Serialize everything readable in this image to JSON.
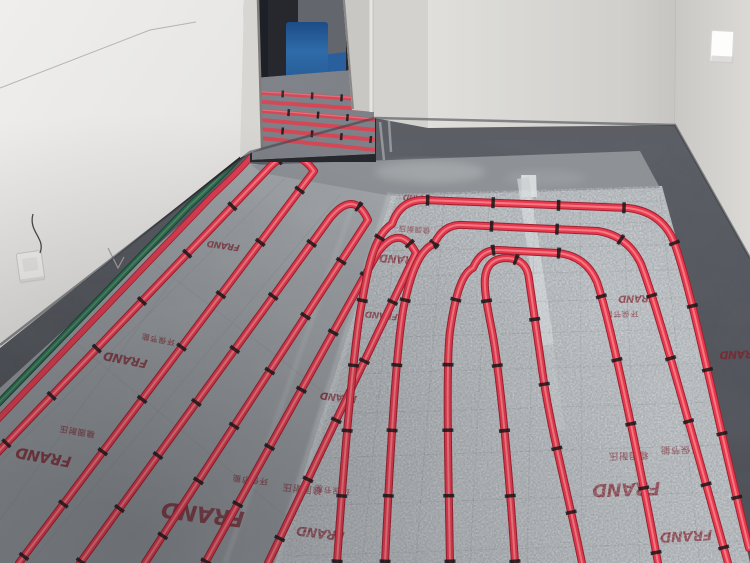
{
  "scene": {
    "type": "photograph",
    "subject": "Hydronic underfloor heating installation: red PEX pipe loops fixed with black clips onto silver foil insulation boards in an unfinished room with a doorway",
    "insulation": {
      "brand": "FRAND",
      "tagline_1": "稳固耐压",
      "tagline_2": "环保节能",
      "print_color": "#7c232f",
      "board_silver": "#a9aeb2",
      "board_matte": "#9c9fa2"
    },
    "pipes": {
      "heating_pipe_color": "#e83a4e",
      "supply_pipe_color": "#2f6e50",
      "clip_color": "#17171a"
    },
    "room": {
      "wall_color": "#e9e8e6",
      "border_band_color": "#55585d",
      "screed_color": "#8e9296",
      "door_interior_color": "#26282e",
      "bucket_blue": "#2e68a6"
    }
  }
}
